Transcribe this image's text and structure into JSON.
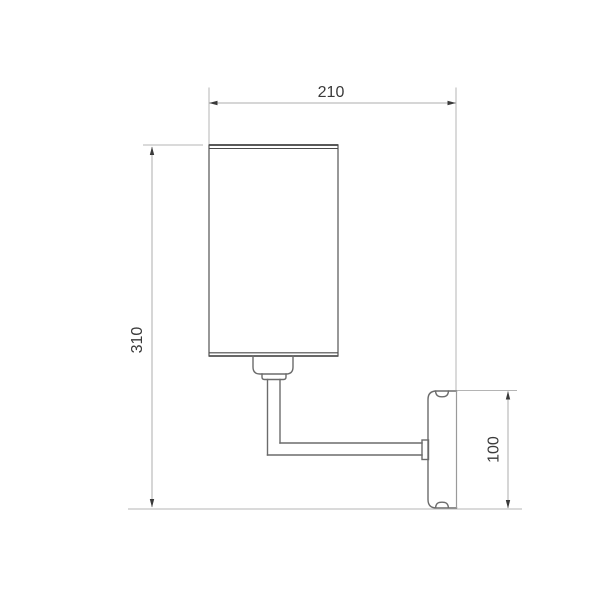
{
  "drawing": {
    "description": "wall sconce technical dimension drawing",
    "dimensions": {
      "overall_depth": {
        "label": "210"
      },
      "overall_height": {
        "label": "310"
      },
      "wall_plate_height": {
        "label": "100"
      }
    },
    "colors": {
      "background": "#ffffff",
      "object_line": "#6b6b6b",
      "rim_line": "#4a4a4a",
      "extension_line": "#b4b4b4",
      "label_text": "#3a3a3a"
    }
  }
}
